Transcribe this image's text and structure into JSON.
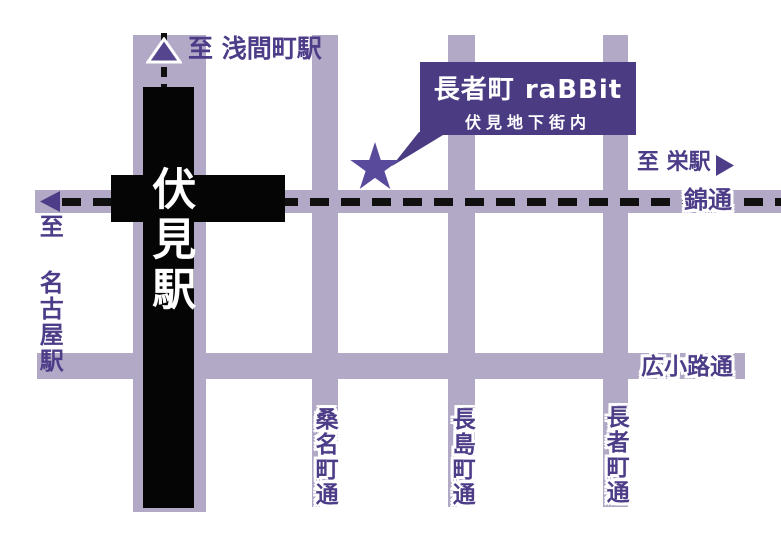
{
  "title": "長者町 raBBit アクセスマップ",
  "callout": {
    "line1": "長者町 raBBit",
    "line2": "伏見地下街内"
  },
  "station": {
    "name": "伏見駅"
  },
  "directions": {
    "north": "至 浅間町駅",
    "west": "至 名古屋駅",
    "east": "至 栄駅"
  },
  "streets": {
    "nishiki": "錦通",
    "hirokoji": "広小路通",
    "kuwanacho": "桑名町通",
    "nagashimacho": "長島町通",
    "chojamacho": "長者町通"
  },
  "markers": {
    "destination": "star-icon",
    "north_marker": "triangle-up-icon",
    "west_marker": "arrow-left-icon",
    "east_marker": "arrow-right-icon"
  },
  "colors": {
    "road": "#b2a9c6",
    "rail": "#050505",
    "accent_text": "#4d3d88",
    "callout_bg": "#4a3b82",
    "star": "#5a4a9c",
    "background": "#ffffff"
  }
}
